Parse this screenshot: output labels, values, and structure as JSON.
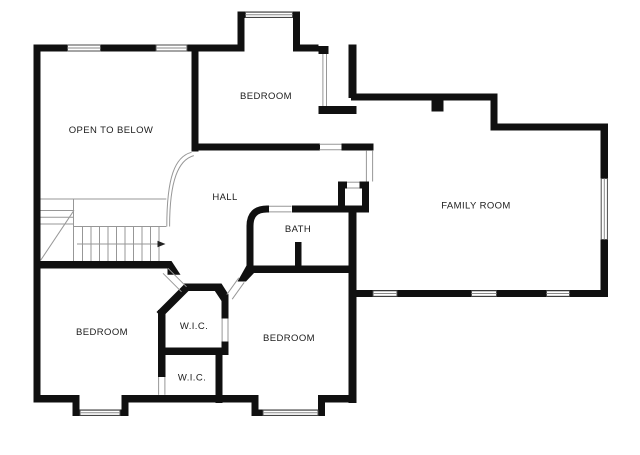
{
  "floor_plan": {
    "colors": {
      "background": "#ffffff",
      "wall": "#101010",
      "thin_line": "#979797",
      "label": "#1c1c1c"
    },
    "rooms": [
      {
        "id": "open-to-below",
        "label": "OPEN TO BELOW"
      },
      {
        "id": "bedroom-top",
        "label": "BEDROOM"
      },
      {
        "id": "hall",
        "label": "HALL"
      },
      {
        "id": "bath",
        "label": "BATH"
      },
      {
        "id": "family-room",
        "label": "FAMILY ROOM"
      },
      {
        "id": "wic-upper",
        "label": "W.I.C."
      },
      {
        "id": "bedroom-left",
        "label": "BEDROOM"
      },
      {
        "id": "wic-lower",
        "label": "W.I.C."
      },
      {
        "id": "bedroom-right",
        "label": "BEDROOM"
      }
    ],
    "icons": {
      "stairs_direction_arrow": "right-arrow"
    }
  }
}
